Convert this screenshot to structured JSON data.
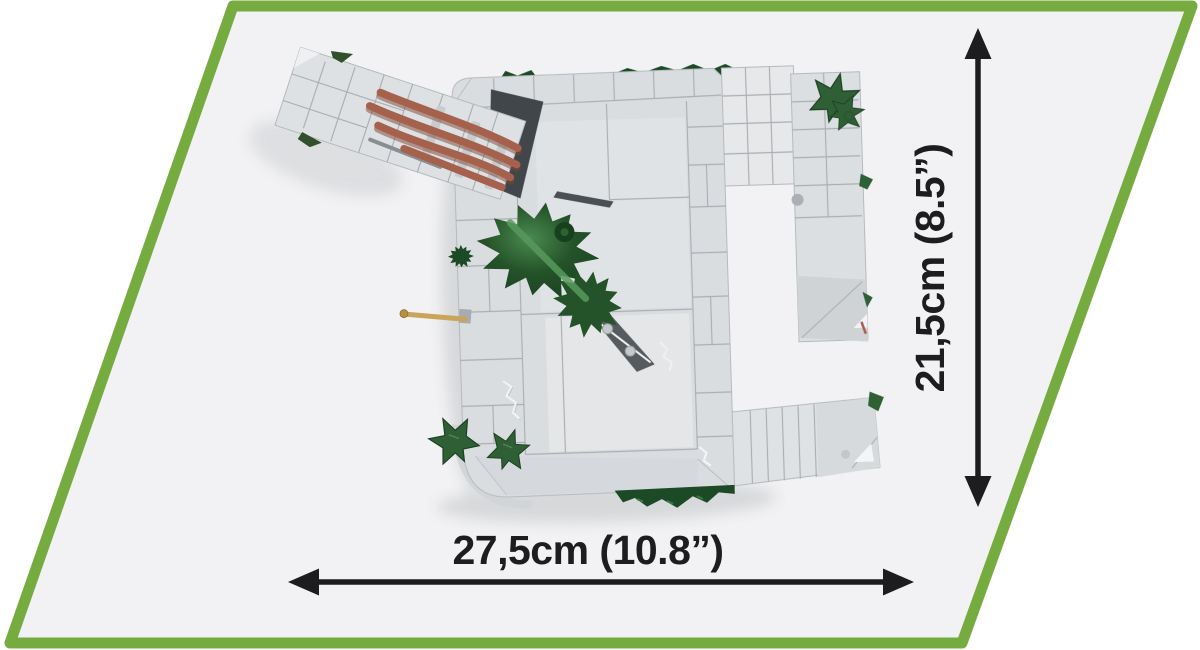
{
  "product_diagram": {
    "type": "product-dimensions-top-view",
    "dimensions": {
      "width_label": "27,5cm (10.8”)",
      "height_label": "21,5cm (8.5”)"
    },
    "model": {
      "description": "gray brick bunker model seen from above with green foliage, ivy leaves, brown logs on a tilted ramp and a tan periscope rod"
    },
    "colors": {
      "frame_green": "#76ab40",
      "panel_bg": "#f2f2f4",
      "outer_bg": "#ffffff",
      "dimension_ink": "#1d1d1f",
      "brick_light": "#dadde0",
      "brick_lighter": "#e7e9eb",
      "brick_line": "#a7acb0",
      "foliage_green": "#2e6d36",
      "foliage_dark": "#1d4a26",
      "ivy_green": "#2f5f35",
      "log_brown": "#a5614b",
      "rod_tan": "#c9a45a"
    }
  }
}
